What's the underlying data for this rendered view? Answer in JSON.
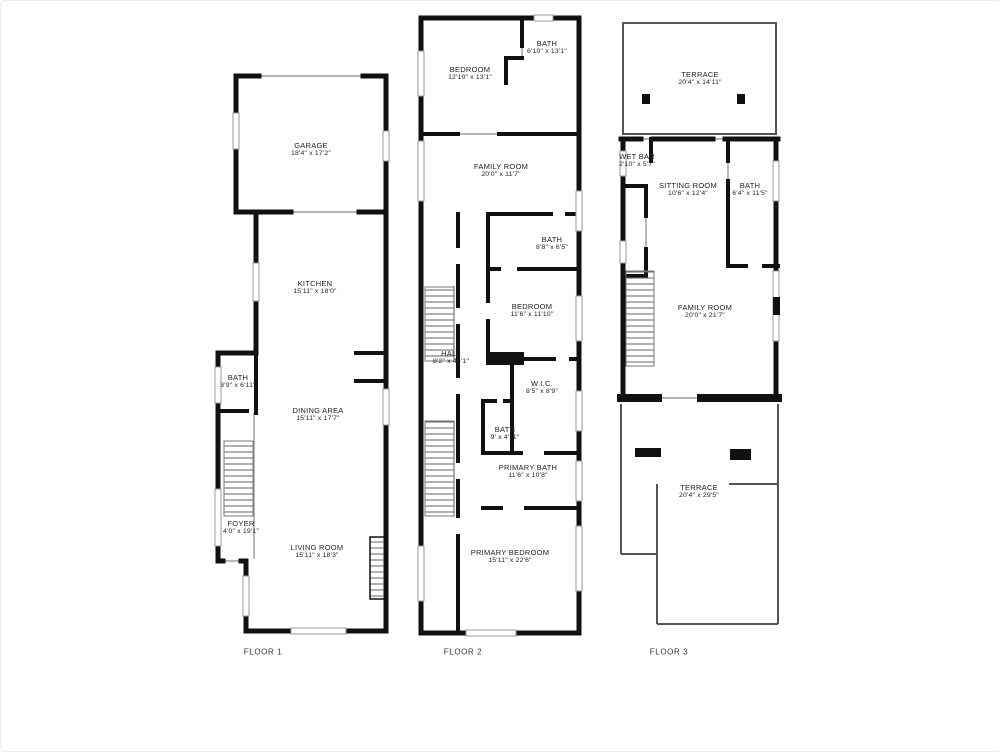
{
  "palette": {
    "wall": "#111111",
    "thin_wall": "#555555",
    "window": "#999999",
    "text": "#222222",
    "background": "#ffffff"
  },
  "floors": [
    {
      "caption": "FLOOR 1",
      "rooms": [
        {
          "name": "GARAGE",
          "dims": "18'4\" x 17'2\""
        },
        {
          "name": "KITCHEN",
          "dims": "15'11\" x 18'0\""
        },
        {
          "name": "BATH",
          "dims": "3'9\" x 6'11\""
        },
        {
          "name": "DINING AREA",
          "dims": "15'11\" x 17'7\""
        },
        {
          "name": "FOYER",
          "dims": "4'0\" x 19'1\""
        },
        {
          "name": "LIVING ROOM",
          "dims": "15'11\" x 18'3\""
        }
      ]
    },
    {
      "caption": "FLOOR 2",
      "rooms": [
        {
          "name": "BEDROOM",
          "dims": "12'10\" x 13'1\""
        },
        {
          "name": "BATH",
          "dims": "6'10\" x 13'1\""
        },
        {
          "name": "FAMILY ROOM",
          "dims": "20'0\" x 11'7\""
        },
        {
          "name": "BATH",
          "dims": "8'8\" x 6'5\""
        },
        {
          "name": "BEDROOM",
          "dims": "11'6\" x 11'10\""
        },
        {
          "name": "HALL",
          "dims": "8'2\" x 45'1\""
        },
        {
          "name": "W.I.C.",
          "dims": "8'5\" x 8'9\""
        },
        {
          "name": "BATH",
          "dims": "9' x 4'11\""
        },
        {
          "name": "PRIMARY BATH",
          "dims": "11'6\" x 10'8\""
        },
        {
          "name": "PRIMARY BEDROOM",
          "dims": "15'11\" x 22'6\""
        }
      ]
    },
    {
      "caption": "FLOOR 3",
      "rooms": [
        {
          "name": "TERRACE",
          "dims": "20'4\" x 14'11\""
        },
        {
          "name": "WET BAR",
          "dims": "2'10\" x 5'7\""
        },
        {
          "name": "SITTING ROOM",
          "dims": "10'6\" x 12'4\""
        },
        {
          "name": "BATH",
          "dims": "6'4\" x 11'5\""
        },
        {
          "name": "FAMILY ROOM",
          "dims": "20'0\" x 21'7\""
        },
        {
          "name": "TERRACE",
          "dims": "20'4\" x 29'5\""
        }
      ]
    }
  ]
}
